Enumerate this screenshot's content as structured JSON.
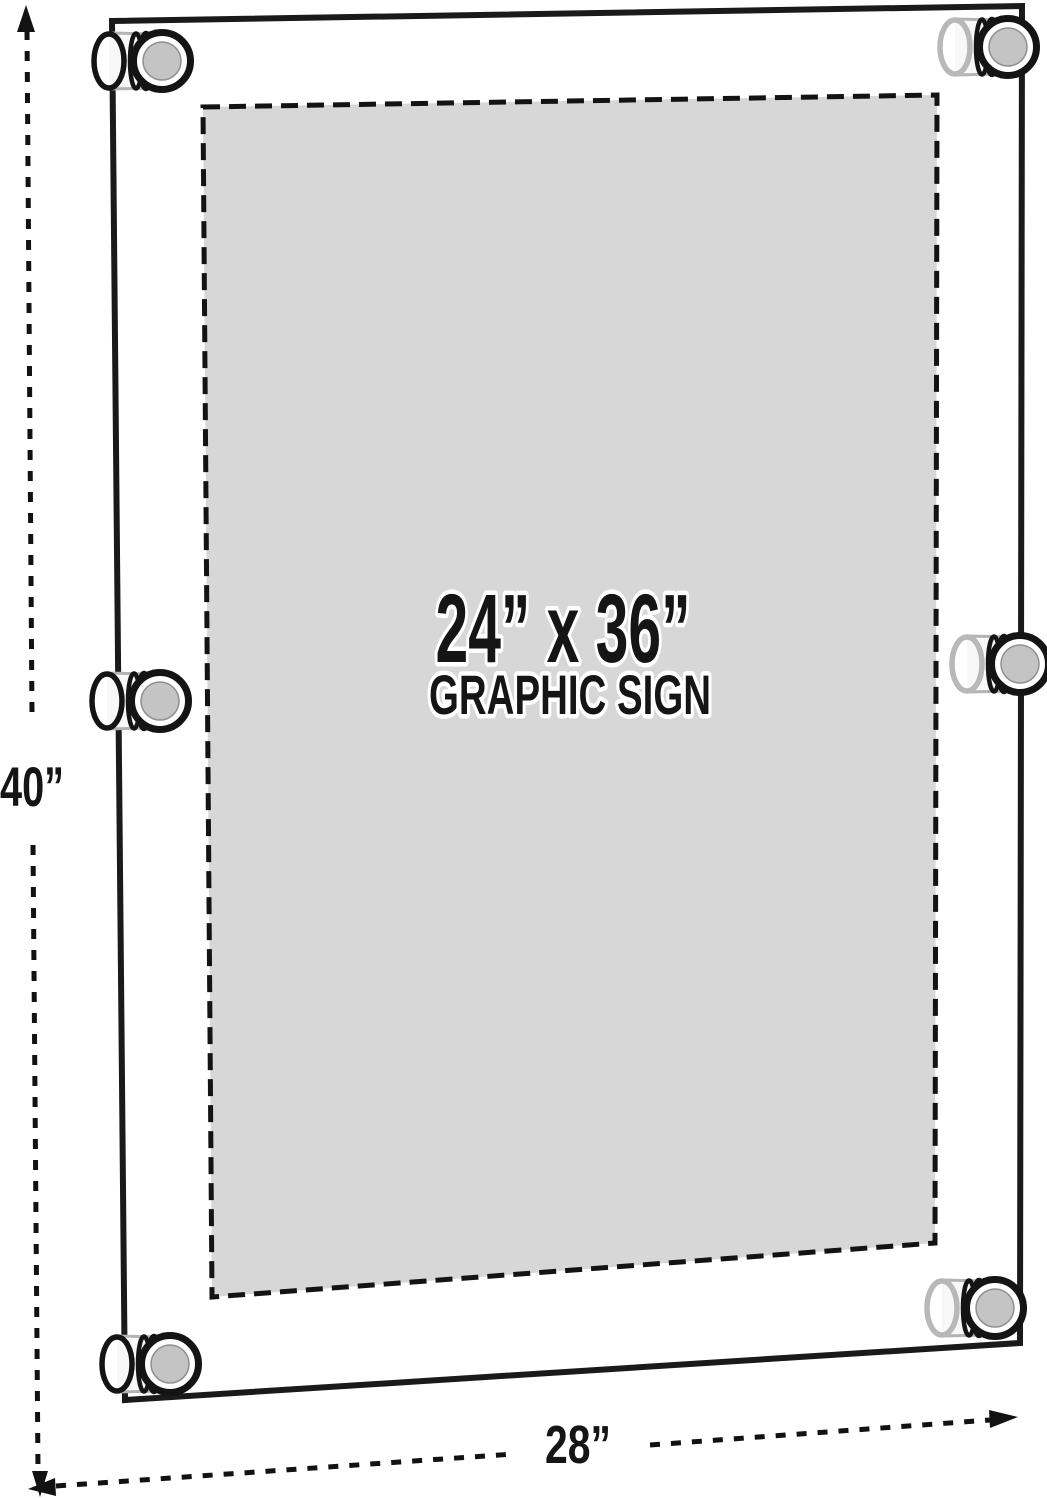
{
  "sign": {
    "size_label": "24” x 36”",
    "type_label": "GRAPHIC SIGN"
  },
  "dimensions": {
    "height_label": "40”",
    "width_label": "28”"
  },
  "hardware": {
    "standoff_count": 6
  },
  "colors": {
    "background": "#ffffff",
    "frame_stroke": "#1a1a1a",
    "graphic_area_fill": "#d7d7d7",
    "line_color": "#121212",
    "standoff_cap_face": "#c4c4c4"
  }
}
